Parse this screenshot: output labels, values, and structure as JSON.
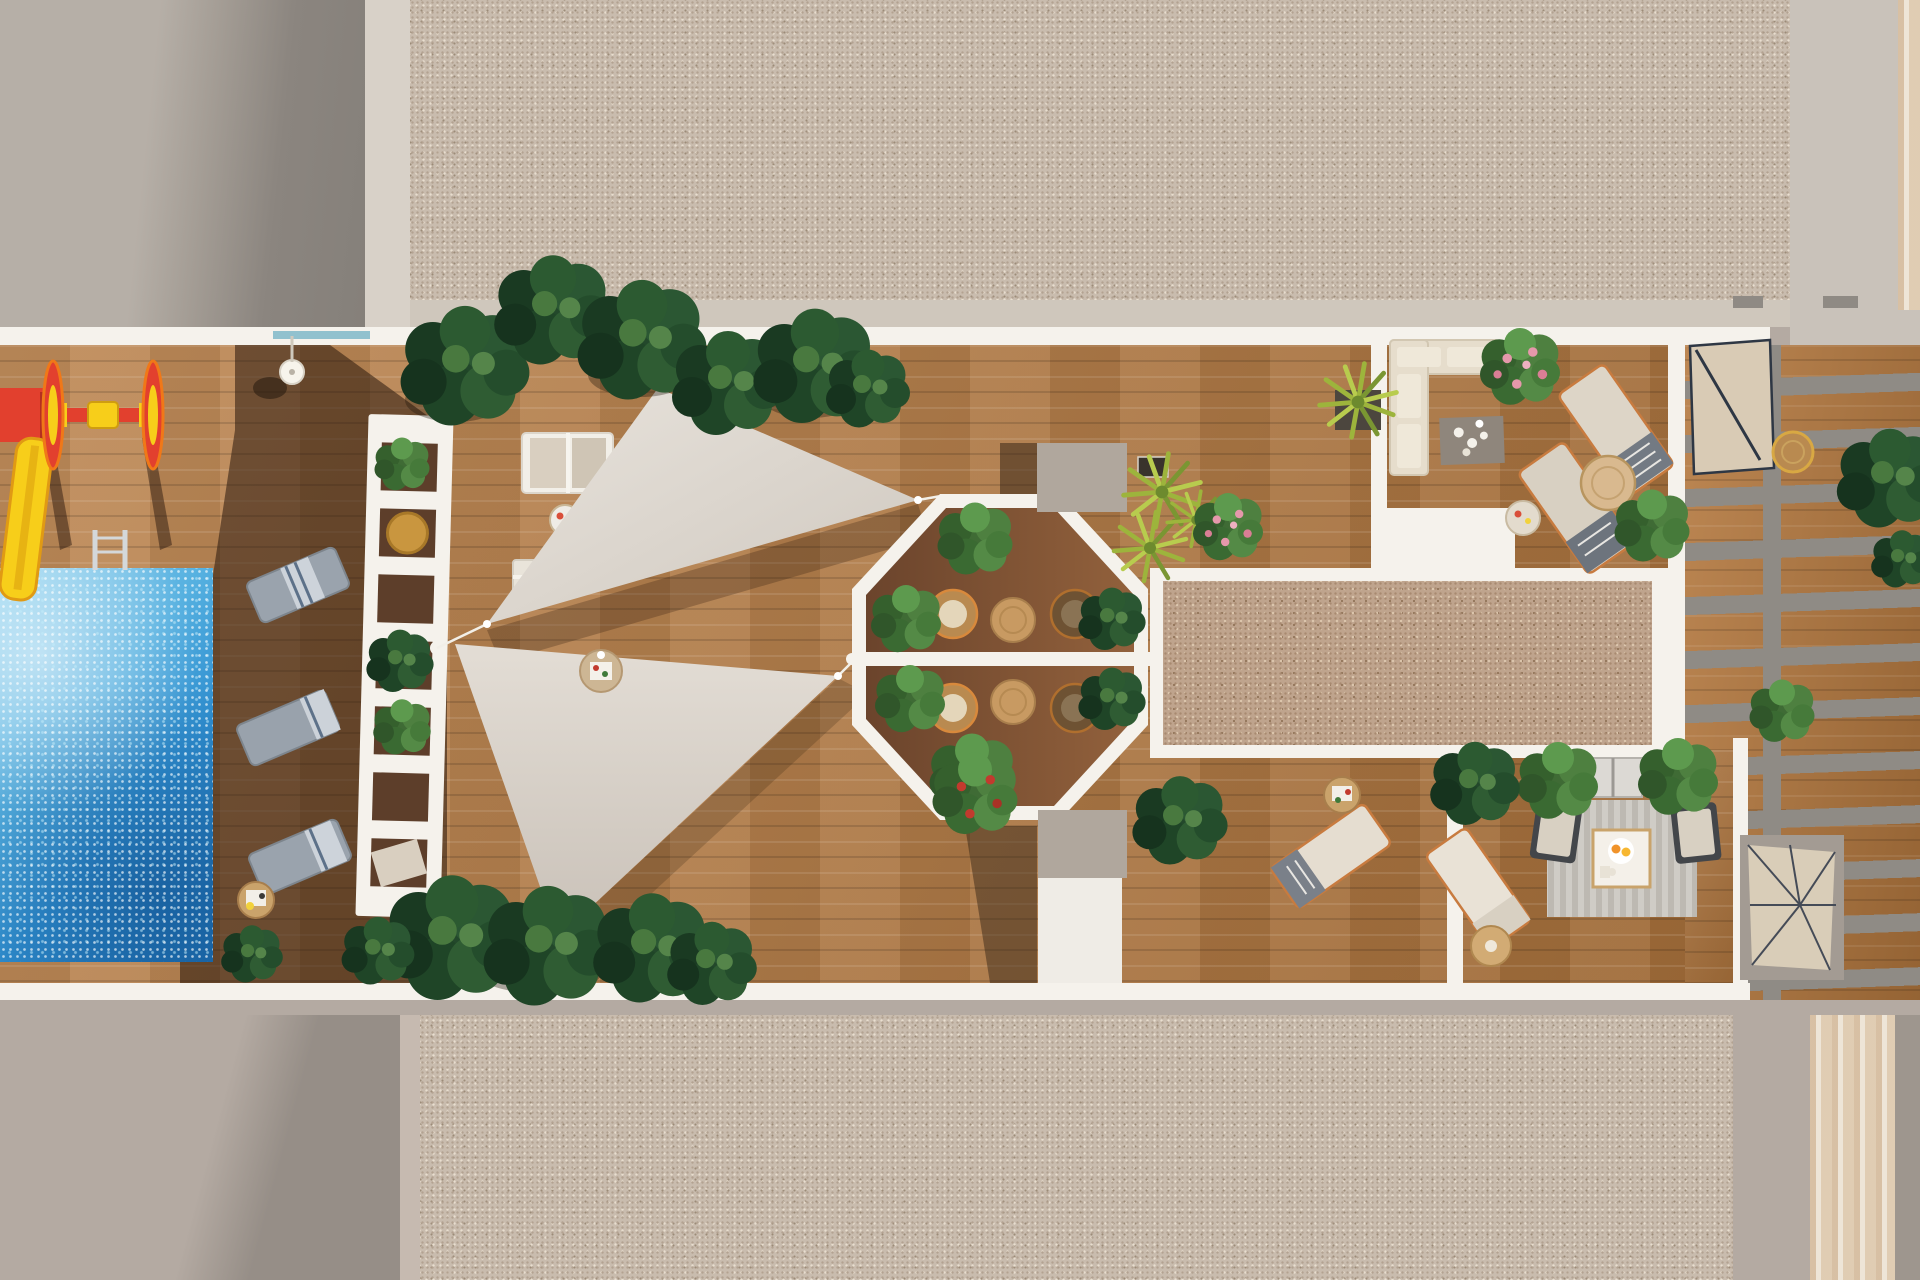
{
  "scene": {
    "title": "Aerial 3D render of a rooftop amenity terrace",
    "areas": [
      "swimming-pool",
      "children-playground",
      "poolside-lounger-row",
      "slatted-shade-structure",
      "double-shade-sails",
      "octagonal-dining-patio",
      "outdoor-lounge-corner",
      "central-gravel-lawn",
      "fire-pit-seating-nook",
      "side-pergola-with-stairs",
      "upper-roof-slabs"
    ],
    "objects": [
      "yellow-slide",
      "red-spinner",
      "pool-ladder",
      "sun-loungers",
      "bistro-tables",
      "rattan-chairs",
      "planter-bushes",
      "grass-planters",
      "corner-sofa",
      "coffee-table",
      "round-side-tables",
      "deck-lamp",
      "striped-rug",
      "spiral-stairs",
      "cantilever-parasol"
    ]
  },
  "palette": {
    "wallLight": "#b6afa7",
    "wallShadow": "#8b857f",
    "whiteTrim": "#f5f2ec",
    "beigeStrip": "#d8d1c8",
    "slabBase": "#c9bcae",
    "slabBandSmooth": "#cfc7bc",
    "taupe": "#b4aaa2",
    "taupeDark": "#968e87",
    "deckWood": "#b5793f",
    "deckWoodDark": "#6e4a31",
    "octagonWoodA": "#6b442c",
    "octagonWoodB": "#92613c",
    "poolBlue": "#2f8fd0",
    "poolLight": "#9ad6f0",
    "poolDeep": "#1e72b4",
    "rugSpeckle": "#bfa48d",
    "grayBox": "#b0a79d",
    "sailLight": "#e8e3dc",
    "sailDark": "#cfc8bf",
    "pergolaBeam": "#8f8b85",
    "furnitureBeige": "#ddd5c7",
    "copperFrame": "#c87b3f",
    "plantDark": "#1f4527",
    "plantLight": "#49793f",
    "grassGreen": "#9db43c",
    "accentRed": "#e2402e",
    "accentYellow": "#f7ce1a",
    "glassTeal": "#7fb9c9",
    "charcoal": "#43464a"
  }
}
